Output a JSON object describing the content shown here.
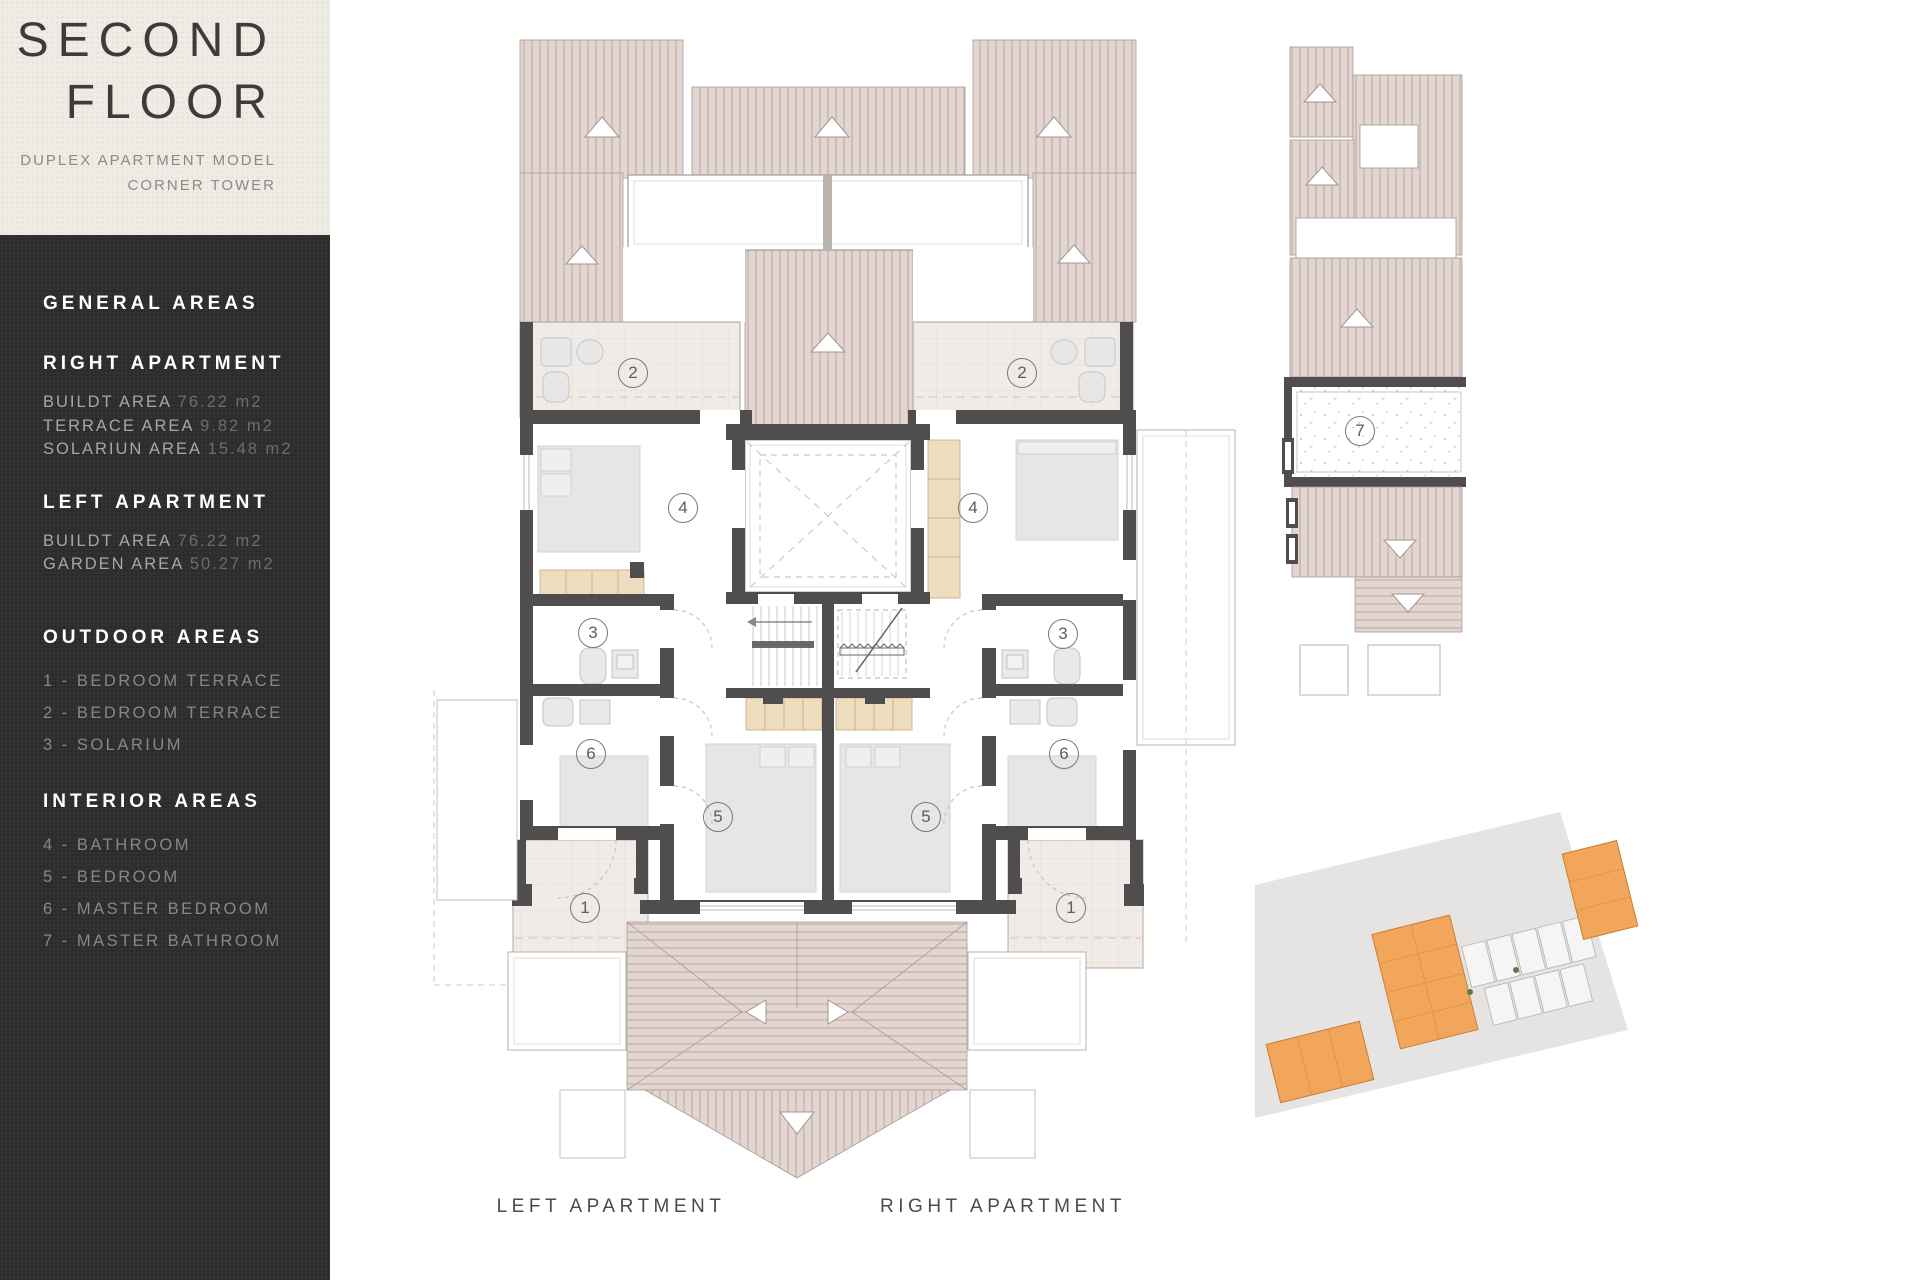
{
  "title_block": {
    "line1": "SECOND",
    "line2": "FLOOR",
    "subtitle_line1": "DUPLEX APARTMENT MODEL",
    "subtitle_line2": "CORNER TOWER"
  },
  "sidebar": {
    "sections": [
      {
        "heading": "GENERAL AREAS",
        "items": []
      },
      {
        "heading": "RIGHT APARTMENT",
        "items": [
          {
            "label": "BUILDT AREA",
            "value": "76.22 m2"
          },
          {
            "label": "TERRACE AREA",
            "value": "9.82 m2"
          },
          {
            "label": "SOLARIUN AREA",
            "value": "15.48 m2"
          }
        ]
      },
      {
        "heading": "LEFT APARTMENT",
        "items": [
          {
            "label": "BUILDT AREA",
            "value": "76.22 m2"
          },
          {
            "label": "GARDEN AREA",
            "value": "50.27 m2"
          }
        ]
      },
      {
        "heading": "OUTDOOR AREAS",
        "numbered": true,
        "items": [
          {
            "label": "1 - BEDROOM TERRACE"
          },
          {
            "label": "2 - BEDROOM TERRACE"
          },
          {
            "label": "3 - SOLARIUM"
          }
        ]
      },
      {
        "heading": "INTERIOR AREAS",
        "numbered": true,
        "items": [
          {
            "label": "4 - BATHROOM"
          },
          {
            "label": "5 - BEDROOM"
          },
          {
            "label": "6 - MASTER BEDROOM"
          },
          {
            "label": "7 - MASTER BATHROOM"
          }
        ]
      }
    ]
  },
  "plan_labels": {
    "left": "LEFT APARTMENT",
    "right": "RIGHT APARTMENT"
  },
  "floor_plan": {
    "markers": [
      {
        "label": "2",
        "x": 633,
        "y": 373
      },
      {
        "label": "2",
        "x": 1022,
        "y": 373
      },
      {
        "label": "4",
        "x": 683,
        "y": 508
      },
      {
        "label": "4",
        "x": 973,
        "y": 508
      },
      {
        "label": "3",
        "x": 593,
        "y": 633
      },
      {
        "label": "3",
        "x": 1063,
        "y": 634
      },
      {
        "label": "6",
        "x": 591,
        "y": 754
      },
      {
        "label": "6",
        "x": 1064,
        "y": 754
      },
      {
        "label": "5",
        "x": 718,
        "y": 817
      },
      {
        "label": "5",
        "x": 926,
        "y": 817
      },
      {
        "label": "1",
        "x": 585,
        "y": 908
      },
      {
        "label": "1",
        "x": 1071,
        "y": 908
      },
      {
        "label": "7",
        "x": 1360,
        "y": 431
      }
    ]
  },
  "colors": {
    "sidebar_bg": "#2e2c2c",
    "title_bg": "#efece6",
    "roof_fill": "#e3d5d0",
    "roof_line": "#b1a09a",
    "wall": "#4f4d4e",
    "terrace_fill": "#f1ebe7",
    "wardrobe_fill": "#eddcbe",
    "furniture": "#e6e6e6",
    "site_orange": "#f2a65c",
    "site_gray": "#e6e4e2"
  }
}
